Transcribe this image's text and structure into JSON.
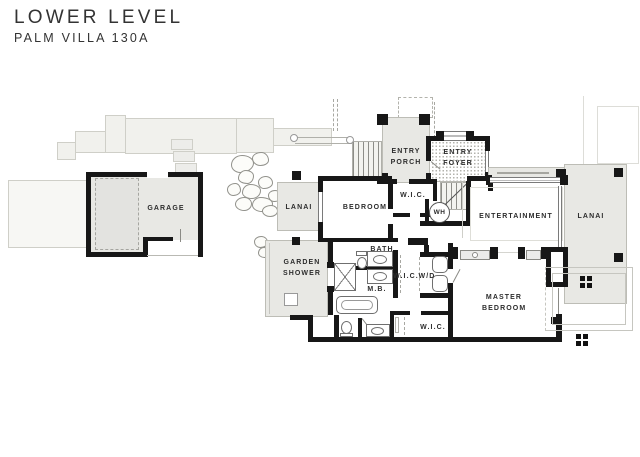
{
  "header": {
    "title": "LOWER LEVEL",
    "subtitle": "PALM VILLA 130A"
  },
  "rooms": {
    "garage": {
      "label": "GARAGE"
    },
    "lanai_left": {
      "label": "LANAI"
    },
    "bedroom": {
      "label": "BEDROOM"
    },
    "entry_porch": {
      "label": "ENTRY PORCH"
    },
    "entry_foyer": {
      "label": "ENTRY FOYER"
    },
    "wic_upper": {
      "label": "W.I.C."
    },
    "water_heater": {
      "label": "WH"
    },
    "entertainment": {
      "label": "ENTERTAINMENT"
    },
    "lanai_right": {
      "label": "LANAI"
    },
    "garden_shower": {
      "label": "GARDEN SHOWER"
    },
    "bath": {
      "label": "BATH"
    },
    "master_bath": {
      "label": "M.B."
    },
    "wic_mid": {
      "label": "W.I.C."
    },
    "washer_dryer": {
      "label": "W/D"
    },
    "master_bedroom": {
      "label": "MASTER BEDROOM"
    },
    "wic_lower": {
      "label": "W.I.C."
    }
  },
  "colors": {
    "wall": "#171717",
    "covered_area_fill": "#e8e8e4",
    "site_fill": "#f1f1ed",
    "label_text": "#2d2d2d"
  }
}
